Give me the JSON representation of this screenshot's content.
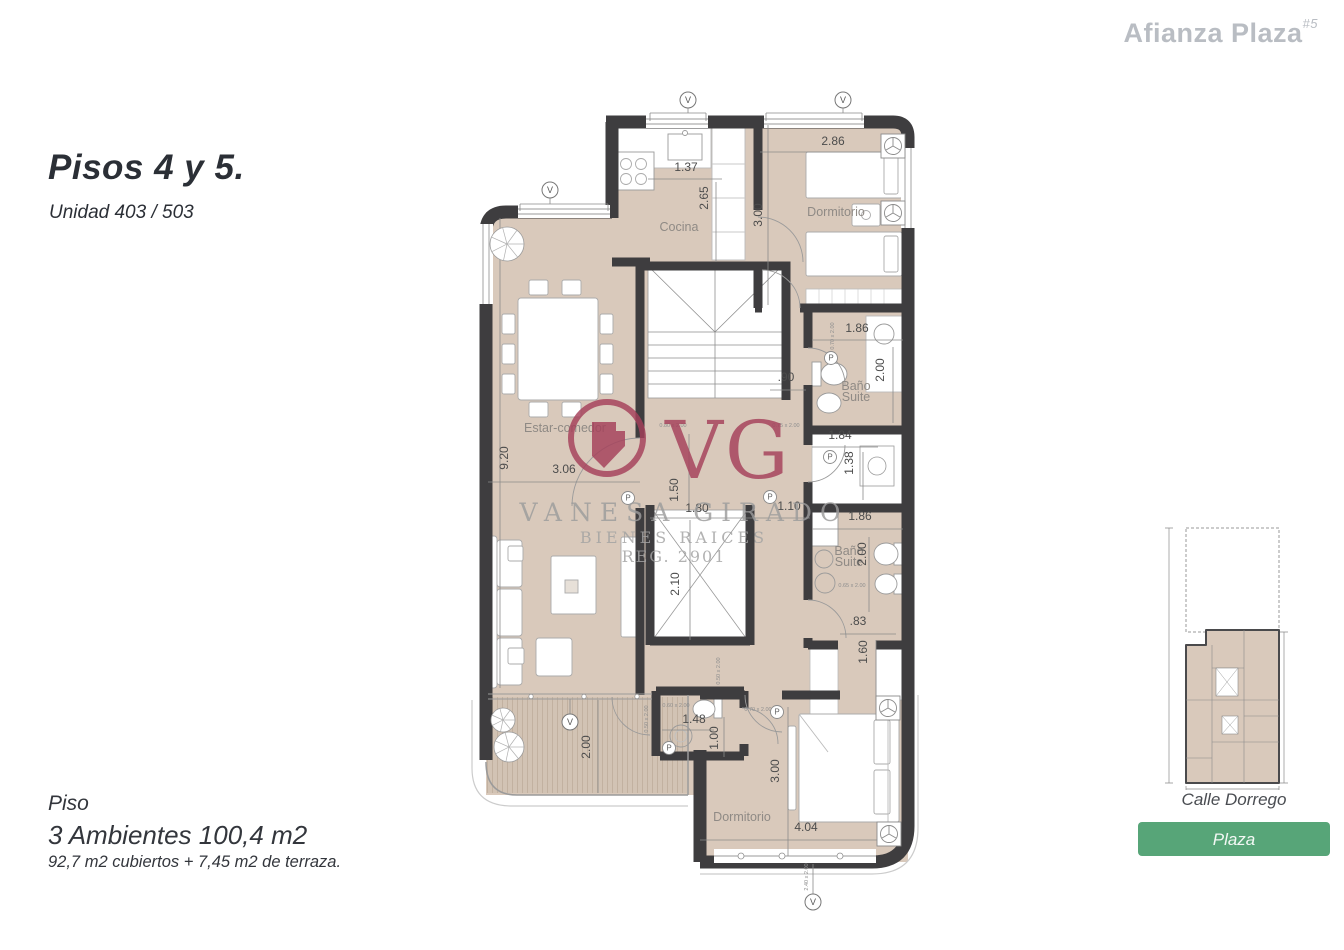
{
  "brand": {
    "name": "Afianza Plaza",
    "superscript": "#5"
  },
  "title": {
    "heading": "Pisos 4 y 5.",
    "subtitle": "Unidad 403 / 503"
  },
  "summary": {
    "line1": "Piso",
    "line2": "3 Ambientes 100,4 m2",
    "line3": "92,7 m2 cubiertos + 7,45 m2 de terraza."
  },
  "sitemap": {
    "street": "Calle Dorrego",
    "button": "Plaza"
  },
  "watermark": {
    "monogram": "VG",
    "name": "VANESA GIRADO",
    "line2": "BIENES RAICES",
    "line3": "REG. 2901"
  },
  "palette": {
    "wall": "#3e3d3f",
    "floor": "#d9c9bb",
    "terrace": "#d2c3b4",
    "maroon": "#a5405a",
    "green": "#57a578",
    "brand_gray": "#b9bdc3",
    "ink": "#2b2f36"
  },
  "plan": {
    "room_labels": [
      {
        "t": "Cocina",
        "x": 679,
        "y": 231
      },
      {
        "t": "Dormitorio",
        "x": 836,
        "y": 216
      },
      {
        "t": "Baño",
        "x": 856,
        "y": 390
      },
      {
        "t": "Suite",
        "x": 856,
        "y": 401
      },
      {
        "t": "Estar-comedor",
        "x": 565,
        "y": 432
      },
      {
        "t": "Baño",
        "x": 849,
        "y": 555
      },
      {
        "t": "Suite",
        "x": 849,
        "y": 566
      },
      {
        "t": "Dormitorio",
        "x": 742,
        "y": 821
      }
    ],
    "dimensions": [
      {
        "t": "2.86",
        "x": 833,
        "y": 145
      },
      {
        "t": "3.00",
        "x": 762,
        "y": 215,
        "rot": -90
      },
      {
        "t": "1.37",
        "x": 686,
        "y": 171
      },
      {
        "t": "2.65",
        "x": 708,
        "y": 198,
        "rot": -90
      },
      {
        "t": "1.86",
        "x": 857,
        "y": 332
      },
      {
        "t": "2.00",
        "x": 884,
        "y": 370,
        "rot": -90
      },
      {
        "t": ".90",
        "x": 786,
        "y": 381
      },
      {
        "t": "1.84",
        "x": 840,
        "y": 439
      },
      {
        "t": "1.38",
        "x": 853,
        "y": 463,
        "rot": -90
      },
      {
        "t": "1.86",
        "x": 860,
        "y": 520
      },
      {
        "t": "2.00",
        "x": 866,
        "y": 554,
        "rot": -90
      },
      {
        "t": ".83",
        "x": 858,
        "y": 625
      },
      {
        "t": "1.60",
        "x": 867,
        "y": 652,
        "rot": -90
      },
      {
        "t": "9.20",
        "x": 508,
        "y": 458,
        "rot": -90
      },
      {
        "t": "3.06",
        "x": 564,
        "y": 473
      },
      {
        "t": "1.50",
        "x": 678,
        "y": 490,
        "rot": -90
      },
      {
        "t": "1.80",
        "x": 697,
        "y": 512
      },
      {
        "t": "1.10",
        "x": 789,
        "y": 510
      },
      {
        "t": "2.10",
        "x": 679,
        "y": 584,
        "rot": -90
      },
      {
        "t": "1.48",
        "x": 694,
        "y": 723
      },
      {
        "t": "1.00",
        "x": 718,
        "y": 738,
        "rot": -90
      },
      {
        "t": "3.00",
        "x": 779,
        "y": 771,
        "rot": -90
      },
      {
        "t": "4.04",
        "x": 806,
        "y": 831
      },
      {
        "t": "2.00",
        "x": 590,
        "y": 747,
        "rot": -90
      }
    ],
    "door_labels": [
      {
        "t": "0.80 x 2.00",
        "x": 673,
        "y": 427
      },
      {
        "t": "0.75 x 2.00",
        "x": 786,
        "y": 427
      },
      {
        "t": "0.70 x 2.00",
        "x": 834,
        "y": 336,
        "rot": -90
      },
      {
        "t": "0.65 x 2.00",
        "x": 852,
        "y": 587
      },
      {
        "t": "0.60 x 2.00",
        "x": 676,
        "y": 707
      },
      {
        "t": "0.50 x 2.00",
        "x": 648,
        "y": 719,
        "rot": -90
      },
      {
        "t": "0.70 x 2.00",
        "x": 758,
        "y": 711
      },
      {
        "t": "0.50 x 2.00",
        "x": 720,
        "y": 671,
        "rot": -90
      },
      {
        "t": "2.40 x 2.00",
        "x": 808,
        "y": 877,
        "rot": -90
      }
    ],
    "markers": {
      "vent": [
        {
          "x": 688,
          "y": 100
        },
        {
          "x": 843,
          "y": 100
        },
        {
          "x": 550,
          "y": 190
        },
        {
          "x": 570,
          "y": 722
        },
        {
          "x": 813,
          "y": 902
        }
      ],
      "vent_letter": "V",
      "door_p": [
        {
          "x": 628,
          "y": 498
        },
        {
          "x": 770,
          "y": 497
        },
        {
          "x": 831,
          "y": 358
        },
        {
          "x": 669,
          "y": 748
        },
        {
          "x": 777,
          "y": 712
        },
        {
          "x": 830,
          "y": 457
        }
      ],
      "door_letter": "P",
      "fan": [
        {
          "x": 893,
          "y": 146
        },
        {
          "x": 893,
          "y": 213
        },
        {
          "x": 888,
          "y": 708
        },
        {
          "x": 889,
          "y": 834
        }
      ],
      "plant": [
        {
          "x": 507,
          "y": 244,
          "r": 17
        },
        {
          "x": 503,
          "y": 720,
          "r": 12
        },
        {
          "x": 509,
          "y": 747,
          "r": 15
        }
      ]
    }
  }
}
